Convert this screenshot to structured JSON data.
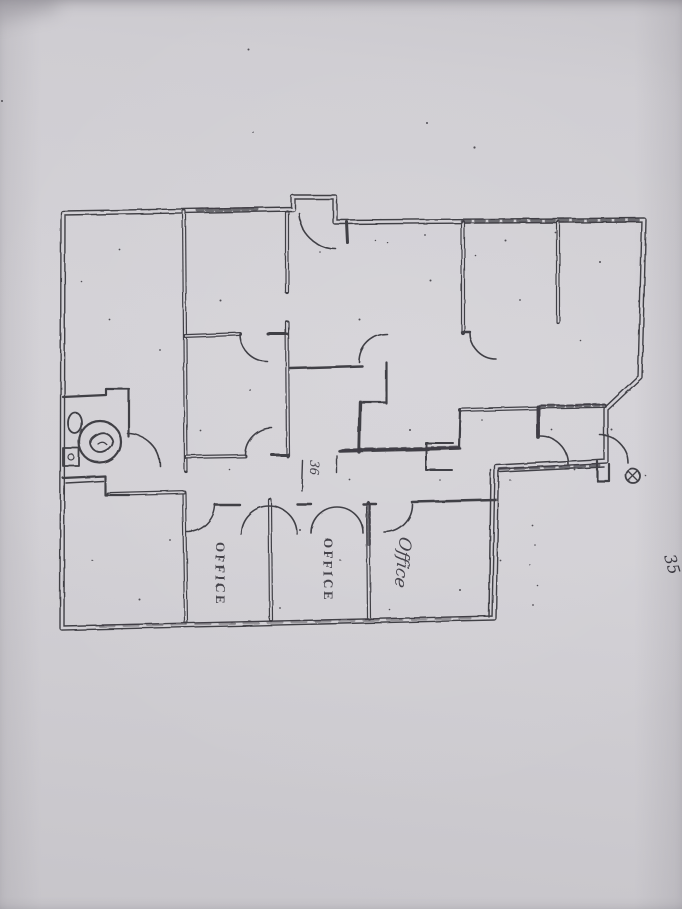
{
  "document": {
    "kind": "Photograph of a scanned architectural floor plan",
    "paper_color": "#d2d0d5",
    "ink_color": "#36343b"
  },
  "labels": {
    "office_left": "OFFICE",
    "office_middle": "OFFICE",
    "office_right": "Office",
    "door_dimension": "36",
    "margin_note": "35"
  },
  "symbols": {
    "toilet": "toilet-plan-symbol",
    "sink": "sink-plan-symbol",
    "column": "column-grid-marker"
  }
}
